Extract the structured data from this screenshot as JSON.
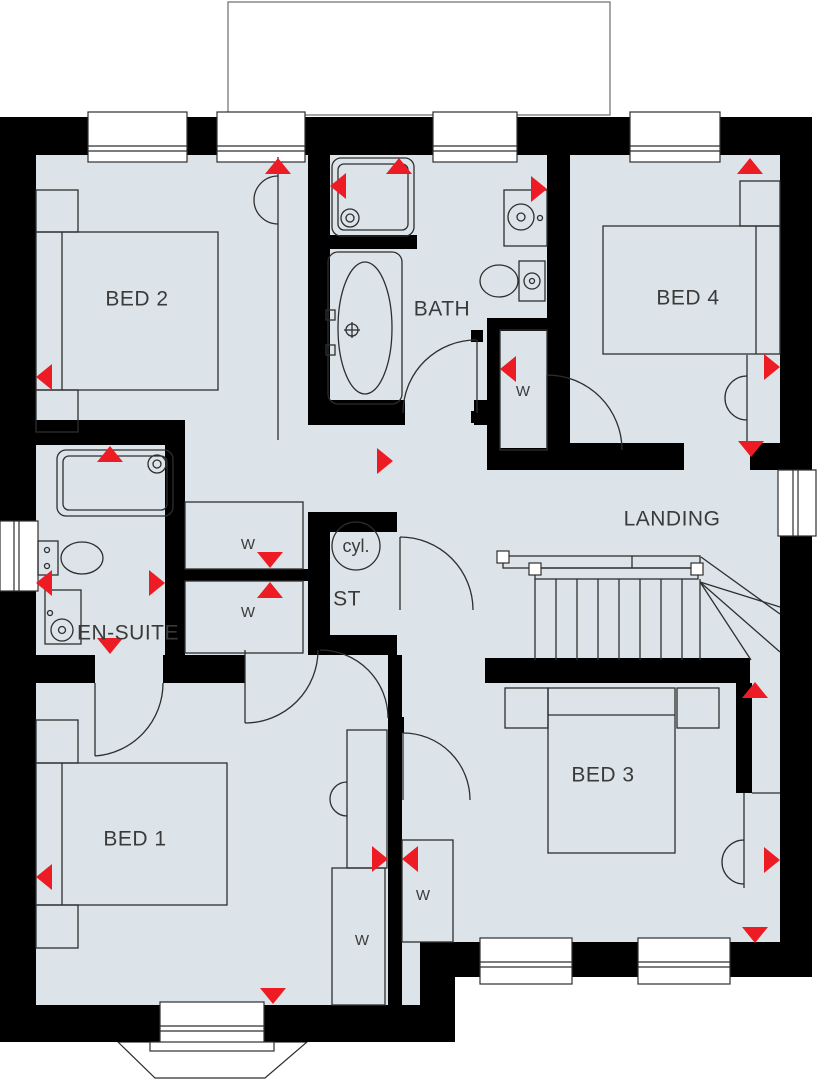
{
  "colors": {
    "background": "#ffffff",
    "room_fill": "#dce4e9",
    "wall": "#000000",
    "line": "#2e2e2e",
    "text": "#3a3a3a",
    "marker_red": "#ed1c24"
  },
  "rooms": {
    "bed1": {
      "label": "BED 1"
    },
    "bed2": {
      "label": "BED 2"
    },
    "bed3": {
      "label": "BED 3"
    },
    "bed4": {
      "label": "BED 4"
    },
    "bath": {
      "label": "BATH"
    },
    "ensuite": {
      "label": "EN-SUITE"
    },
    "landing": {
      "label": "LANDING"
    },
    "store": {
      "label": "ST"
    }
  },
  "fixtures": {
    "cylinder_label": "cyl.",
    "wardrobe_label": "W"
  },
  "markers": [
    {
      "x": 278,
      "y": 158,
      "dir": "up"
    },
    {
      "x": 399,
      "y": 158,
      "dir": "up"
    },
    {
      "x": 750,
      "y": 158,
      "dir": "up"
    },
    {
      "x": 330,
      "y": 186,
      "dir": "left"
    },
    {
      "x": 547,
      "y": 189,
      "dir": "right"
    },
    {
      "x": 780,
      "y": 367,
      "dir": "right"
    },
    {
      "x": 751,
      "y": 457,
      "dir": "down"
    },
    {
      "x": 500,
      "y": 369,
      "dir": "left"
    },
    {
      "x": 36,
      "y": 377,
      "dir": "left"
    },
    {
      "x": 110,
      "y": 446,
      "dir": "up"
    },
    {
      "x": 36,
      "y": 583,
      "dir": "left"
    },
    {
      "x": 165,
      "y": 583,
      "dir": "right"
    },
    {
      "x": 270,
      "y": 568,
      "dir": "down"
    },
    {
      "x": 270,
      "y": 582,
      "dir": "up"
    },
    {
      "x": 110,
      "y": 654,
      "dir": "down"
    },
    {
      "x": 393,
      "y": 461,
      "dir": "right"
    },
    {
      "x": 36,
      "y": 877,
      "dir": "left"
    },
    {
      "x": 273,
      "y": 1004,
      "dir": "down"
    },
    {
      "x": 388,
      "y": 859,
      "dir": "right"
    },
    {
      "x": 402,
      "y": 859,
      "dir": "left"
    },
    {
      "x": 755,
      "y": 682,
      "dir": "up"
    },
    {
      "x": 780,
      "y": 860,
      "dir": "right"
    },
    {
      "x": 755,
      "y": 943,
      "dir": "down"
    }
  ]
}
